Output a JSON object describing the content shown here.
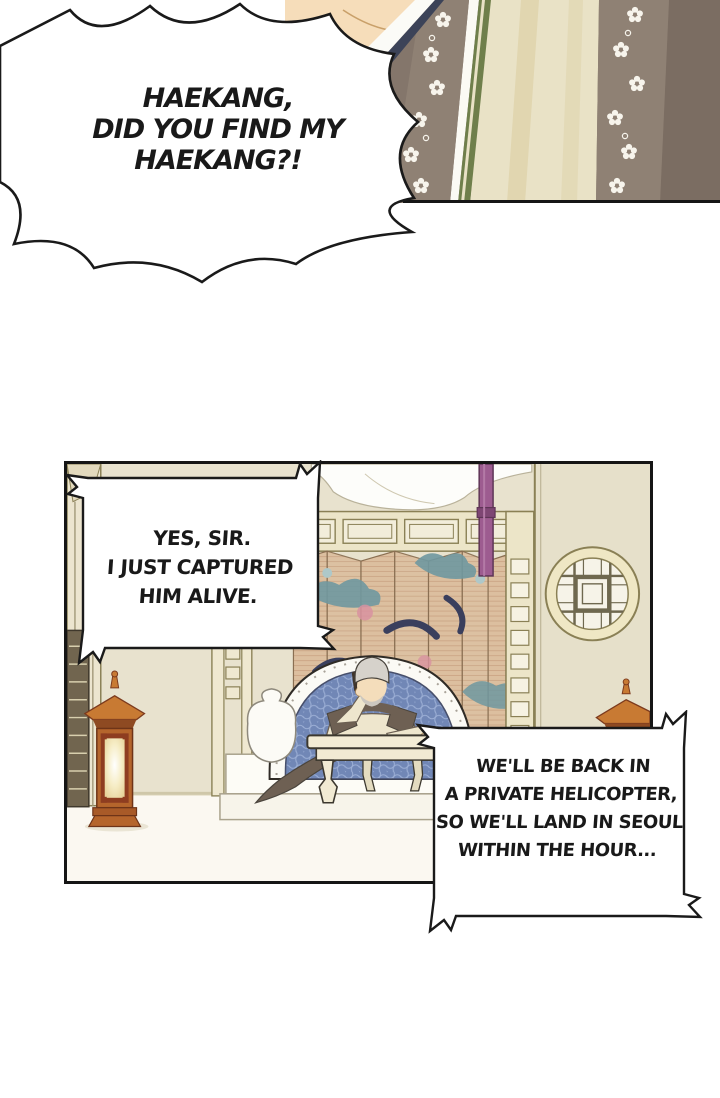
{
  "page": {
    "type": "webtoon-comic-page",
    "background": "#ffffff"
  },
  "bubbles": {
    "shout": {
      "style": "burst",
      "lines": [
        "HAEKANG,",
        "DID YOU FIND MY",
        "HAEKANG?!"
      ]
    },
    "reply": {
      "style": "spiked-rect",
      "lines": [
        "YES, SIR.",
        "I JUST CAPTURED",
        "HIM ALIVE."
      ]
    },
    "report": {
      "style": "spiked-rect",
      "lines": [
        "WE'LL BE BACK IN",
        "A PRIVATE HELICOPTER,",
        "SO WE'LL LAND IN SEOUL",
        "WITHIN THE HOUR..."
      ]
    }
  },
  "panels": {
    "top_partial": {
      "description": "close-up of a figure in traditional taupe robes with white floral lapel bands, green trim and cream inner robe"
    },
    "main": {
      "description": "palace room: elderly white-haired man on a phone behind a low table, blue scale-pattern seat arch, cloud-motif folding screen, magenta pillars, round lattice window, standing lanterns"
    }
  },
  "colors": {
    "ink": "#1a1a1a",
    "wall": "#e8e2ce",
    "floor": "#fbf8f1",
    "robe_taupe": "#8b7d71",
    "robe_cream": "#e9e2c6",
    "collar_green": "#6f7f4b",
    "skin": "#f6ddba",
    "pillar_magenta": "#9d5c90",
    "screen_tan": "#dcbf9f",
    "cloud_teal": "#6f98a0",
    "cloud_navy": "#3a3f5d",
    "cloud_pink": "#d892a0",
    "seat_blue": "#7187b6",
    "lantern_orange": "#c87a33",
    "lantern_dark": "#8e4a22",
    "lattice_cream": "#ece5c8",
    "frame_olive": "#8a8055"
  }
}
